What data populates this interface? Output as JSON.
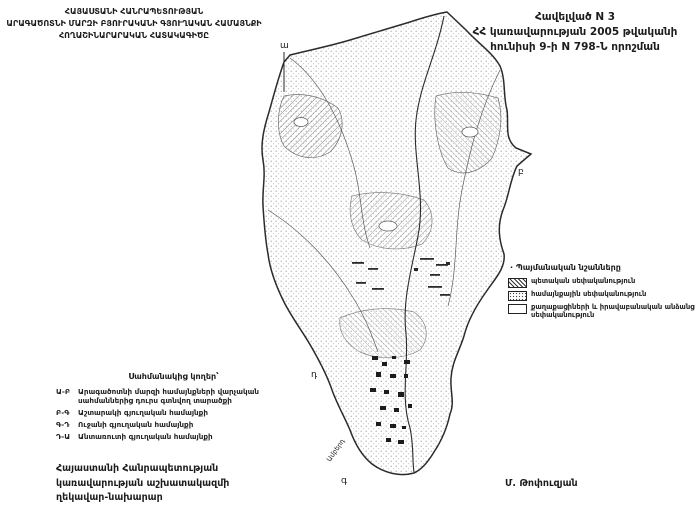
{
  "header": {
    "title_line1": "ՀԱՅԱՍՏԱՆԻ ՀԱՆՐԱՊԵՏՈՒԹՅԱՆ",
    "title_line2": "ԱՐԱԳԱԾՈՏՆԻ ՄԱՐԶԻ ԲՅՈՒՐԱԿԱՆԻ ԳՅՈՒՂԱԿԱՆ ՀԱՄԱՅՆՔԻ",
    "title_line3": "ՀՈՂԱՇԻՆԱՐԱՐԱԿԱՆ ՀԱՏԱԿԱԳԻԾԸ",
    "annex_line1": "Հավելված N 3",
    "annex_line2": "ՀՀ կառավարության 2005 թվականի",
    "annex_line3": "հունիսի 9-ի N 798-Ն որոշման"
  },
  "legend": {
    "bullet": "·",
    "heading": "Պայմանական նշանները",
    "items": [
      {
        "swatch": "hatched",
        "label": "պետական սեփականություն"
      },
      {
        "swatch": "dotted",
        "label": "համայնքային սեփականություն"
      },
      {
        "swatch": "empty",
        "label": "քաղաքացիների և իրավաբանական անձանց սեփականություն"
      }
    ]
  },
  "borders": {
    "heading": "Սահմանակից կողեր՝",
    "items": [
      {
        "code": "Ա-Բ",
        "label": "Արագածոտնի մարզի համայնքների վարչական սահմաններից դուրս գտնվող տարածքի"
      },
      {
        "code": "Բ-Գ",
        "label": "Աշտարակի գյուղական համայնքի"
      },
      {
        "code": "Գ-Դ",
        "label": "Ուջանի գյուղական համայնքի"
      },
      {
        "code": "Դ-Ա",
        "label": "Անտառուտի գյուղական համայնքի"
      }
    ]
  },
  "map": {
    "corner_label_a": "ա",
    "corner_label_b": "բ",
    "corner_label_g": "գ",
    "corner_label_d": "դ",
    "river_label": "Ամբերդ"
  },
  "signature": {
    "office_line1": "Հայաստանի Հանրապետության",
    "office_line2": "կառավարության աշխատակազմի",
    "office_line3": "ղեկավար-նախարար",
    "name": "Մ. Թոփուզյան"
  },
  "colors": {
    "ink": "#1c1c1c",
    "map_stroke": "#2b2b2b",
    "stipple": "#9a9a9a"
  }
}
